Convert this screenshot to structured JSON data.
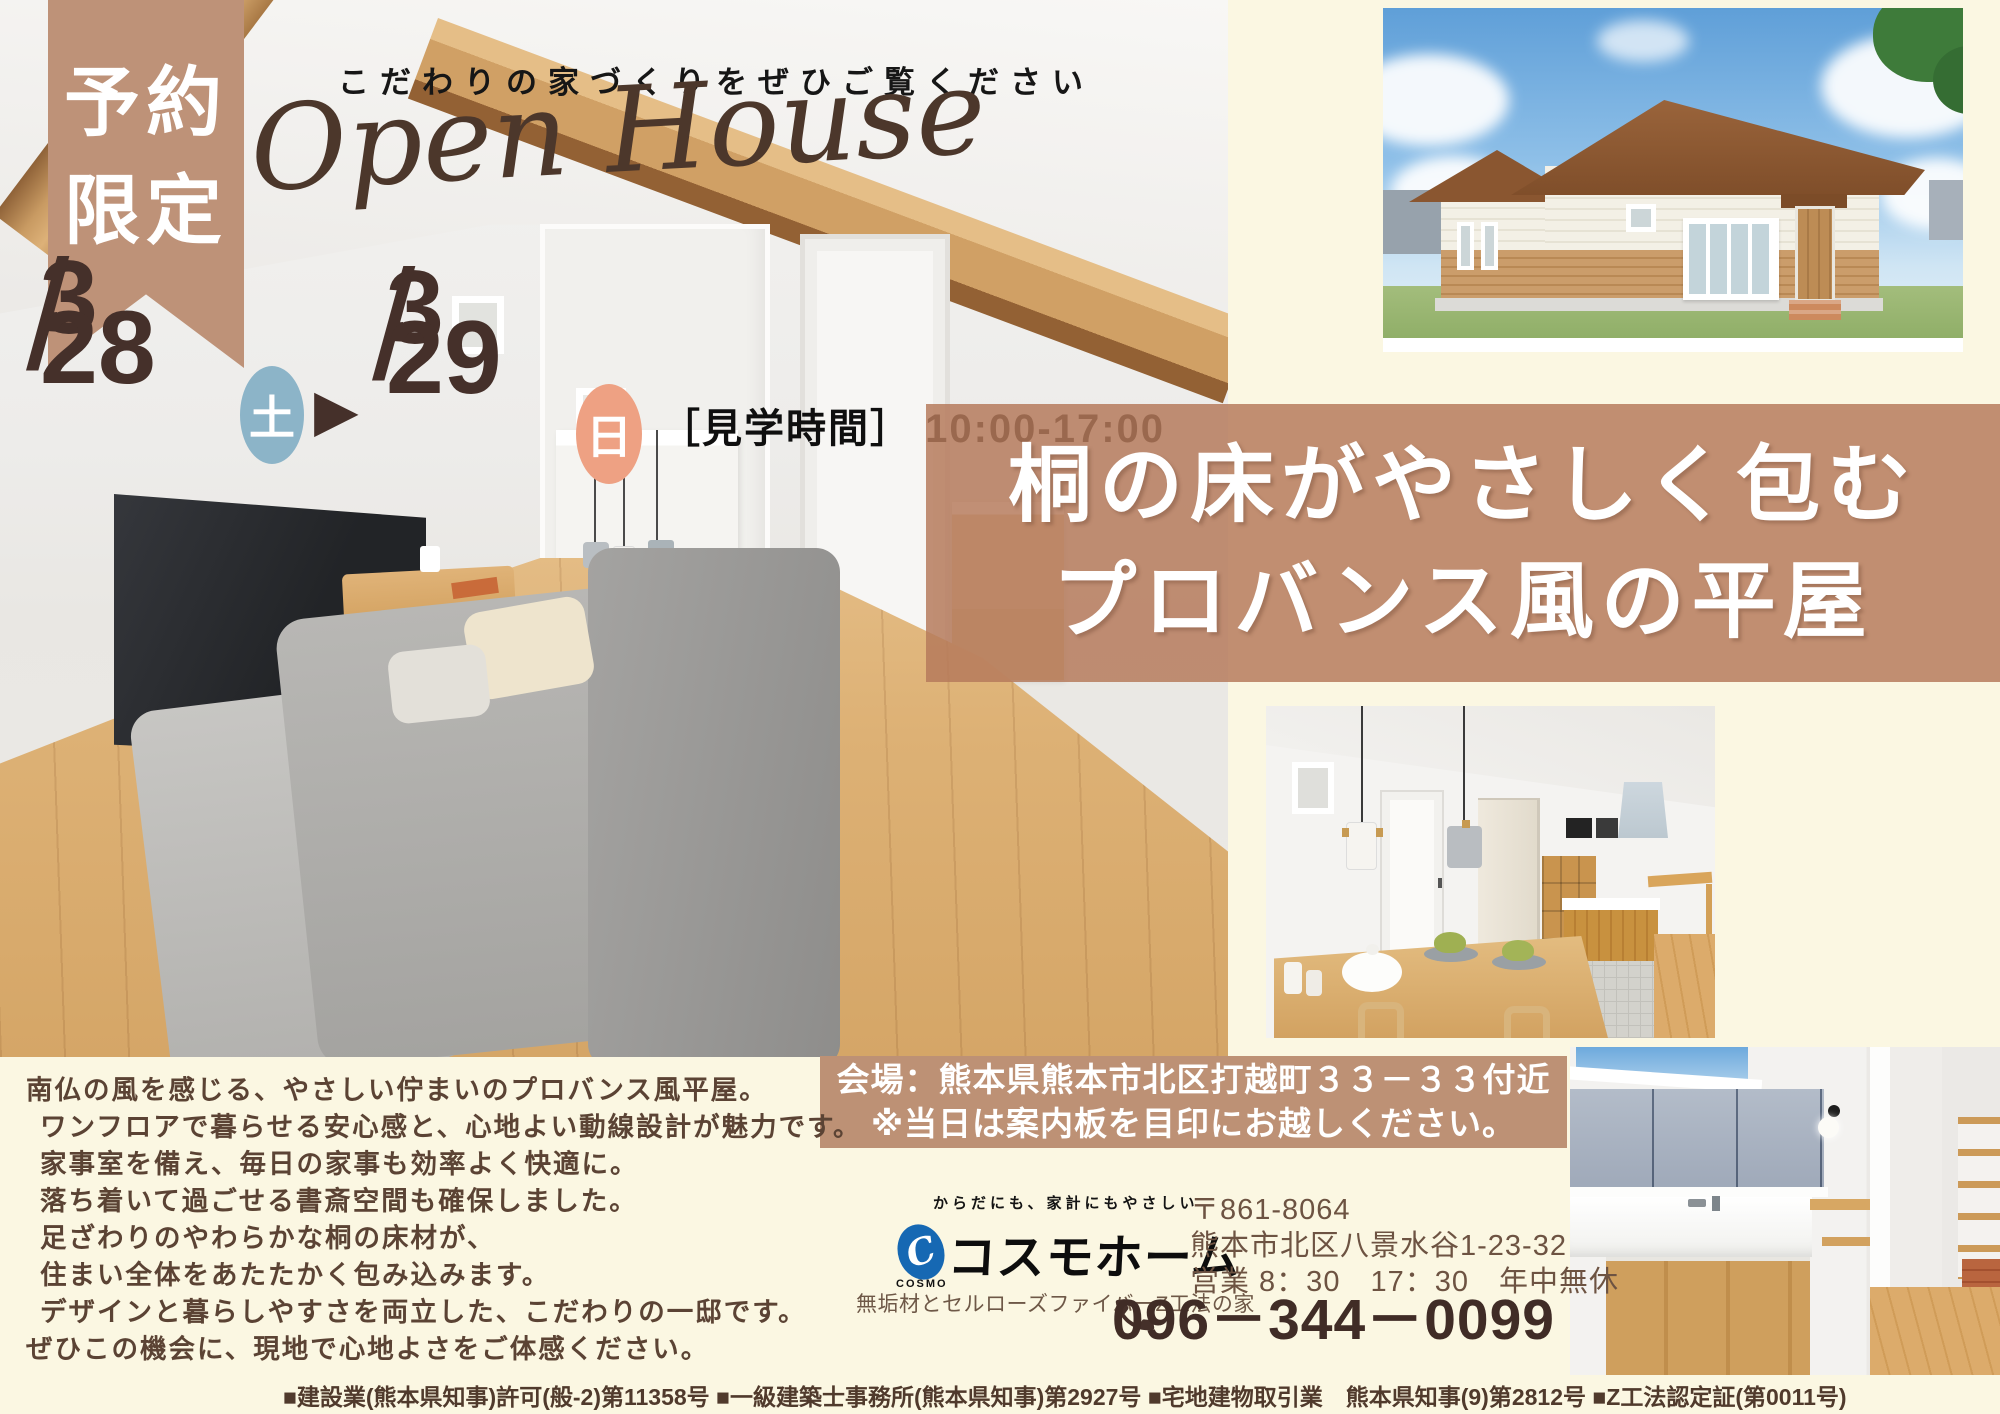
{
  "colors": {
    "background_cream": "#FBF7E2",
    "accent_tan": "#BE9278",
    "band_tan": "#B5795A",
    "venue_band_tan": "#BD9175",
    "saturday_blue": "#8CB4C8",
    "sunday_orange": "#EEA183",
    "logo_blue": "#1668B3",
    "text_brown": "#5B4334",
    "date_brown": "#45302A"
  },
  "ribbon": {
    "line1": "予約",
    "line2": "限定"
  },
  "header": {
    "note": "こだわりの家づくりをぜひご覧ください",
    "script_title": "Open House"
  },
  "dates": {
    "m1": "3",
    "slash1": "/",
    "d1": "28",
    "w1": "土",
    "arrow": "▶",
    "m2": "3",
    "slash2": "/",
    "d2": "29",
    "w2": "日",
    "hours": "［見学時間］ 10:00-17:00"
  },
  "title_band": {
    "line1": "桐の床がやさしく包む",
    "line2": "プロバンス風の平屋"
  },
  "venue_band": {
    "line1": "会場：熊本県熊本市北区打越町３３－３３付近",
    "line2": "※当日は案内板を目印にお越しください。"
  },
  "description": {
    "lines": [
      "南仏の風を感じる、やさしい佇まいのプロバンス風平屋。",
      "ワンフロアで暮らせる安心感と、心地よい動線設計が魅力です。",
      "家事室を備え、毎日の家事も効率よく快適に。",
      "落ち着いて過ごせる書斎空間も確保しました。",
      "足ざわりのやわらかな桐の床材が、",
      "住まい全体をあたたかく包み込みます。",
      "デザインと暮らしやすさを両立した、こだわりの一邸です。",
      "ぜひこの機会に、現地で心地よさをご体感ください。"
    ]
  },
  "company": {
    "tagline": "からだにも、家計にもやさしい",
    "logo_mark": "C",
    "logo_word": "COSMO",
    "name": "コスモホーム",
    "caption": "無垢材とセルローズファイバーZ工法の家",
    "postal": "〒861-8064",
    "address": "熊本市北区八景水谷1-23-32",
    "business_hours": "営業 8：30　17：30　年中無休",
    "phone": "096－344－0099"
  },
  "footer": {
    "license": "■建設業(熊本県知事)許可(般-2)第11358号 ■一級建築士事務所(熊本県知事)第2927号 ■宅地建物取引業　熊本県知事(9)第2812号 ■Z工法認定証(第0011号)"
  }
}
